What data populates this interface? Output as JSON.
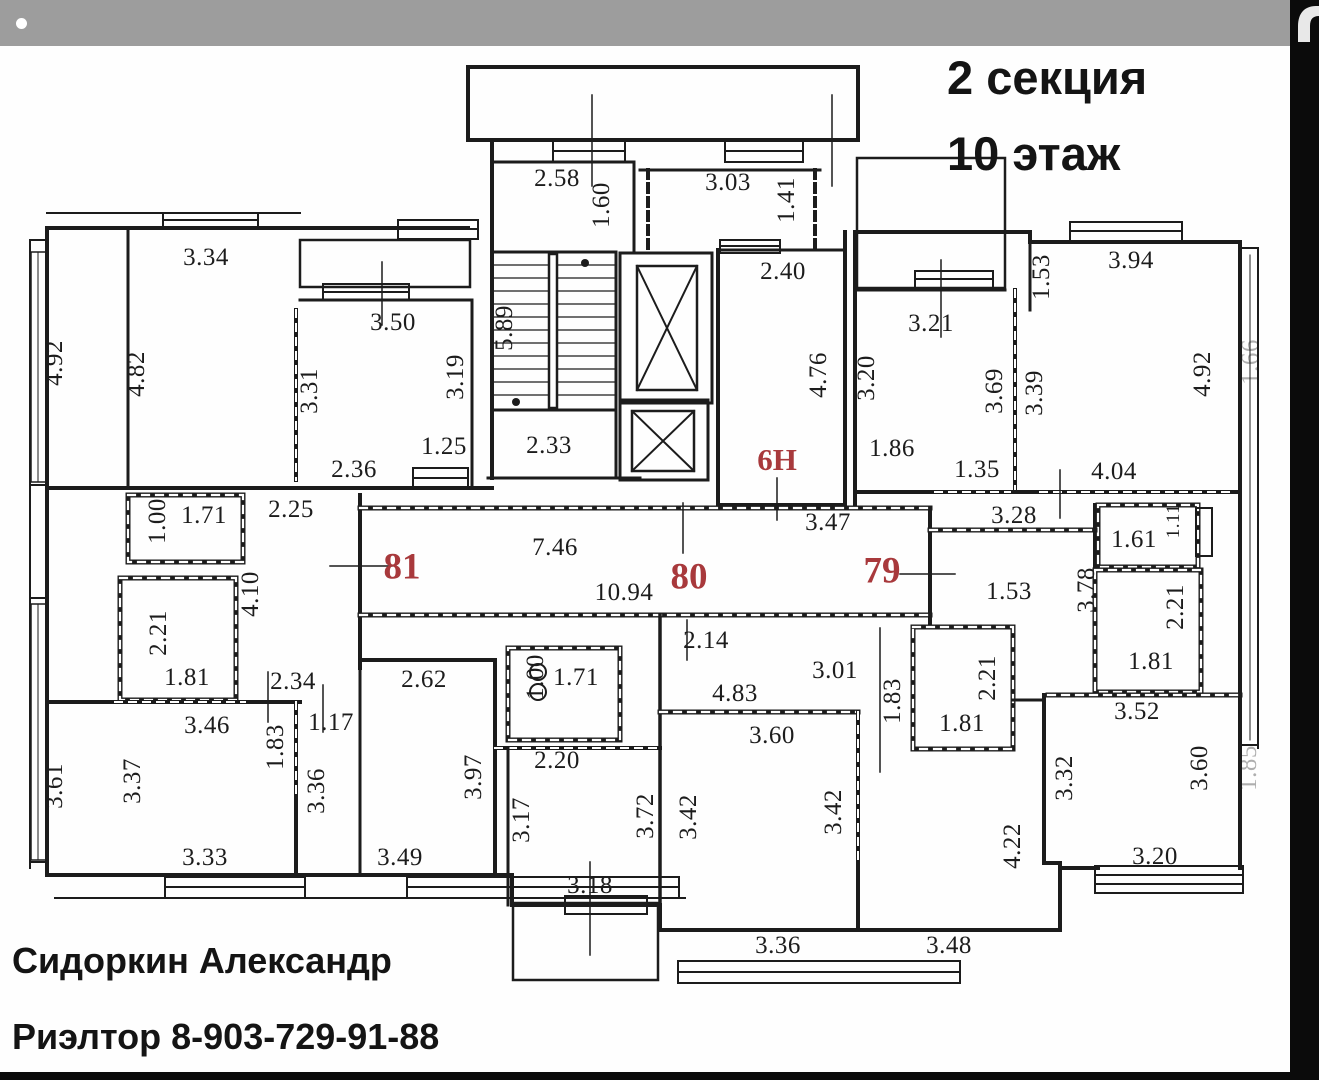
{
  "header": {
    "line1": "2 секция",
    "line2": "10 этаж"
  },
  "footer": {
    "line1": "Сидоркин Александр",
    "line2": "Риэлтор 8-903-729-91-88"
  },
  "colors": {
    "accent_red": "#a8393c",
    "wall_black": "#1c1c1c",
    "topbar_gray": "#9d9d9d",
    "edge_black": "#0b0b0b"
  },
  "apartments": [
    {
      "number": "81",
      "x": 402,
      "y": 567
    },
    {
      "number": "80",
      "x": 689,
      "y": 577
    },
    {
      "number": "79",
      "x": 882,
      "y": 571
    },
    {
      "number": "6Н",
      "x": 777,
      "y": 460,
      "small": true
    }
  ],
  "dimensions": [
    {
      "t": "2.58",
      "x": 557,
      "y": 179,
      "r": 0
    },
    {
      "t": "1.60",
      "x": 602,
      "y": 205,
      "r": 1
    },
    {
      "t": "3.03",
      "x": 728,
      "y": 183,
      "r": 0
    },
    {
      "t": "1.41",
      "x": 787,
      "y": 200,
      "r": 1
    },
    {
      "t": "2.40",
      "x": 783,
      "y": 272,
      "r": 0
    },
    {
      "t": "4.76",
      "x": 819,
      "y": 375,
      "r": 1
    },
    {
      "t": "5.89",
      "x": 505,
      "y": 328,
      "r": 1
    },
    {
      "t": "2.33",
      "x": 549,
      "y": 446,
      "r": 0
    },
    {
      "t": "1.25",
      "x": 444,
      "y": 447,
      "r": 0
    },
    {
      "t": "2.36",
      "x": 354,
      "y": 470,
      "r": 0
    },
    {
      "t": "3.34",
      "x": 206,
      "y": 258,
      "r": 0
    },
    {
      "t": "4.82",
      "x": 137,
      "y": 374,
      "r": 1
    },
    {
      "t": "4.92",
      "x": 55,
      "y": 363,
      "r": 1
    },
    {
      "t": "3.50",
      "x": 393,
      "y": 323,
      "r": 0
    },
    {
      "t": "3.31",
      "x": 310,
      "y": 391,
      "r": 1
    },
    {
      "t": "3.19",
      "x": 456,
      "y": 377,
      "r": 1
    },
    {
      "t": "3.21",
      "x": 931,
      "y": 324,
      "r": 0
    },
    {
      "t": "3.20",
      "x": 867,
      "y": 378,
      "r": 1
    },
    {
      "t": "1.86",
      "x": 892,
      "y": 449,
      "r": 0
    },
    {
      "t": "1.35",
      "x": 977,
      "y": 470,
      "r": 0
    },
    {
      "t": "3.69",
      "x": 995,
      "y": 391,
      "r": 1
    },
    {
      "t": "3.39",
      "x": 1035,
      "y": 393,
      "r": 1
    },
    {
      "t": "1.53",
      "x": 1042,
      "y": 277,
      "r": 1
    },
    {
      "t": "3.94",
      "x": 1131,
      "y": 261,
      "r": 0
    },
    {
      "t": "4.92",
      "x": 1203,
      "y": 374,
      "r": 1
    },
    {
      "t": "4.04",
      "x": 1114,
      "y": 472,
      "r": 0
    },
    {
      "t": "3.28",
      "x": 1014,
      "y": 516,
      "r": 0
    },
    {
      "t": "3.47",
      "x": 828,
      "y": 523,
      "r": 0
    },
    {
      "t": "7.46",
      "x": 555,
      "y": 548,
      "r": 0
    },
    {
      "t": "10.94",
      "x": 624,
      "y": 593,
      "r": 0
    },
    {
      "t": "2.14",
      "x": 706,
      "y": 641,
      "r": 0
    },
    {
      "t": "1.53",
      "x": 1009,
      "y": 592,
      "r": 0
    },
    {
      "t": "3.78",
      "x": 1087,
      "y": 590,
      "r": 1
    },
    {
      "t": "2.25",
      "x": 291,
      "y": 510,
      "r": 0
    },
    {
      "t": "1.71",
      "x": 204,
      "y": 516,
      "r": 0
    },
    {
      "t": "1.00",
      "x": 158,
      "y": 521,
      "r": 1
    },
    {
      "t": "4.10",
      "x": 251,
      "y": 594,
      "r": 1
    },
    {
      "t": "2.21",
      "x": 159,
      "y": 633,
      "r": 1
    },
    {
      "t": "1.81",
      "x": 187,
      "y": 678,
      "r": 0
    },
    {
      "t": "1.61",
      "x": 1134,
      "y": 540,
      "r": 0
    },
    {
      "t": "1.11",
      "x": 1174,
      "y": 521,
      "r": 1,
      "s": true
    },
    {
      "t": "2.21",
      "x": 1176,
      "y": 607,
      "r": 1
    },
    {
      "t": "1.81",
      "x": 1151,
      "y": 662,
      "r": 0
    },
    {
      "t": "3.52",
      "x": 1137,
      "y": 712,
      "r": 0
    },
    {
      "t": "2.34",
      "x": 293,
      "y": 682,
      "r": 0
    },
    {
      "t": "1.17",
      "x": 331,
      "y": 723,
      "r": 0
    },
    {
      "t": "1.83",
      "x": 276,
      "y": 747,
      "r": 1
    },
    {
      "t": "3.46",
      "x": 207,
      "y": 726,
      "r": 0
    },
    {
      "t": "3.37",
      "x": 133,
      "y": 781,
      "r": 1
    },
    {
      "t": "3.36",
      "x": 317,
      "y": 791,
      "r": 1
    },
    {
      "t": "3.61",
      "x": 55,
      "y": 786,
      "r": 1
    },
    {
      "t": "3.33",
      "x": 205,
      "y": 858,
      "r": 0
    },
    {
      "t": "2.62",
      "x": 424,
      "y": 680,
      "r": 0
    },
    {
      "t": "3.97",
      "x": 474,
      "y": 777,
      "r": 1
    },
    {
      "t": "3.49",
      "x": 400,
      "y": 858,
      "r": 0
    },
    {
      "t": "1.71",
      "x": 576,
      "y": 678,
      "r": 0
    },
    {
      "t": "1.00",
      "x": 536,
      "y": 677,
      "r": 1
    },
    {
      "t": "4.83",
      "x": 735,
      "y": 694,
      "r": 0
    },
    {
      "t": "2.20",
      "x": 557,
      "y": 761,
      "r": 0
    },
    {
      "t": "3.01",
      "x": 835,
      "y": 671,
      "r": 0
    },
    {
      "t": "1.83",
      "x": 893,
      "y": 701,
      "r": 1
    },
    {
      "t": "2.21",
      "x": 988,
      "y": 678,
      "r": 1
    },
    {
      "t": "1.81",
      "x": 962,
      "y": 724,
      "r": 0
    },
    {
      "t": "3.60",
      "x": 772,
      "y": 736,
      "r": 0
    },
    {
      "t": "3.17",
      "x": 522,
      "y": 820,
      "r": 1
    },
    {
      "t": "3.72",
      "x": 646,
      "y": 816,
      "r": 1
    },
    {
      "t": "3.42",
      "x": 689,
      "y": 817,
      "r": 1
    },
    {
      "t": "3.42",
      "x": 834,
      "y": 812,
      "r": 1
    },
    {
      "t": "3.18",
      "x": 590,
      "y": 886,
      "r": 0
    },
    {
      "t": "3.36",
      "x": 778,
      "y": 946,
      "r": 0
    },
    {
      "t": "3.48",
      "x": 949,
      "y": 946,
      "r": 0
    },
    {
      "t": "3.32",
      "x": 1065,
      "y": 778,
      "r": 1
    },
    {
      "t": "3.60",
      "x": 1200,
      "y": 768,
      "r": 1
    },
    {
      "t": "4.22",
      "x": 1013,
      "y": 846,
      "r": 1
    },
    {
      "t": "3.20",
      "x": 1155,
      "y": 857,
      "r": 0
    },
    {
      "t": "1.66",
      "x": 1251,
      "y": 362,
      "r": 1,
      "f": true
    },
    {
      "t": "1.85",
      "x": 1249,
      "y": 768,
      "r": 1,
      "f": true
    }
  ]
}
